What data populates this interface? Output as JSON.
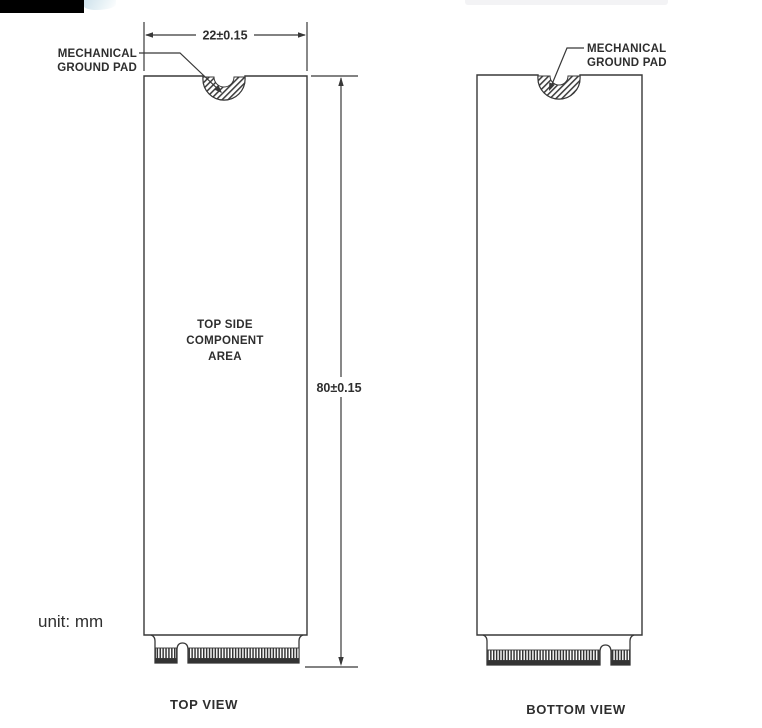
{
  "unit_note": "unit: mm",
  "top_view": {
    "caption": "TOP VIEW",
    "width_dimension": "22±0.15",
    "height_dimension": "80±0.15",
    "ground_pad_label": [
      "MECHANICAL",
      "GROUND PAD"
    ],
    "component_area_label": [
      "TOP SIDE",
      "COMPONENT",
      "AREA"
    ]
  },
  "bottom_view": {
    "caption": "BOTTOM VIEW",
    "ground_pad_label": [
      "MECHANICAL",
      "GROUND PAD"
    ]
  },
  "colors": {
    "line": "#383838",
    "text": "#2e2e2e"
  }
}
